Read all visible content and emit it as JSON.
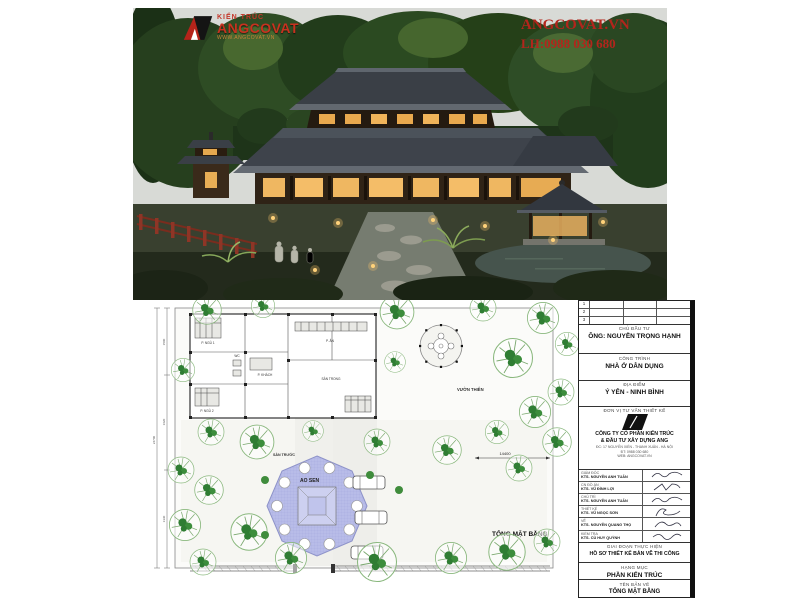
{
  "brand": {
    "logo_top": "KIẾN TRÚC",
    "logo_main": "ANGCOVAT",
    "logo_sub": "WWW.ANGCOVAT.VN",
    "site": "ANGCOVAT.VN",
    "phone": "LH:0988 030 680",
    "accent_red": "#b3251c"
  },
  "plan": {
    "title": "TỔNG MẶT BẰNG",
    "labels": {
      "front_yard": "SÂN TRƯỚC",
      "pond": "AO SEN",
      "zen_garden": "VƯỜN THIÊN",
      "rooms": [
        "P. NGỦ 1",
        "WC",
        "P. KHÁCH",
        "P. ĂN",
        "P. NGỦ 2",
        "SÂN TRONG"
      ]
    },
    "dimensions": {
      "right": "14400",
      "left": [
        "1500",
        "1620",
        "1330"
      ],
      "left_total": "24700"
    }
  },
  "titleblock": {
    "revision_rows": [
      "1",
      "2",
      "3"
    ],
    "investor_label": "CHỦ ĐẦU TƯ",
    "investor": "ÔNG: NGUYỄN TRỌNG HẠNH",
    "project_label": "CÔNG TRÌNH",
    "project": "NHÀ Ở DÂN DỤNG",
    "location_label": "ĐỊA ĐIỂM",
    "location": "Ý YÊN - NINH BÌNH",
    "firm_label": "ĐƠN VỊ TƯ VẤN THIẾT KẾ",
    "firm_name_1": "CÔNG TY CỔ PHẦN KIẾN TRÚC",
    "firm_name_2": "& ĐẦU TƯ XÂY DỰNG ANG",
    "firm_addr": "ĐC: 17 NGUYỄN XIỂN - THANH XUÂN - HÀ NỘI",
    "firm_tel": "ĐT: 0988 030 680",
    "firm_web": "WEB: ANGCOVAT.VN",
    "signatures": [
      {
        "role": "GIÁM ĐỐC",
        "name": "KTS. NGUYỄN ANH TUẤN"
      },
      {
        "role": "CN ĐỒ ÁN",
        "name": "KTS. VŨ ĐÌNH LỢI"
      },
      {
        "role": "CHỦ TRÌ",
        "name": "KTS. NGUYỄN ANH TUẤN"
      },
      {
        "role": "THIẾT KẾ",
        "name": "KTS. VŨ NGỌC SƠN"
      },
      {
        "role": "VẼ",
        "name": "KTS. NGUYỄN QUANG THỌ"
      },
      {
        "role": "KIỂM TRA",
        "name": "KTS. CÙ HUY QUỲNH"
      }
    ],
    "stage_label": "GIAI ĐOẠN THỰC HIỆN",
    "stage": "HỒ SƠ THIẾT KẾ BẢN VẼ THI CÔNG",
    "category_label": "HẠNG MỤC",
    "category": "PHẦN KIẾN TRÚC",
    "sheet_label": "TÊN BẢN VẼ",
    "sheet": "TỔNG MẶT BẰNG"
  }
}
